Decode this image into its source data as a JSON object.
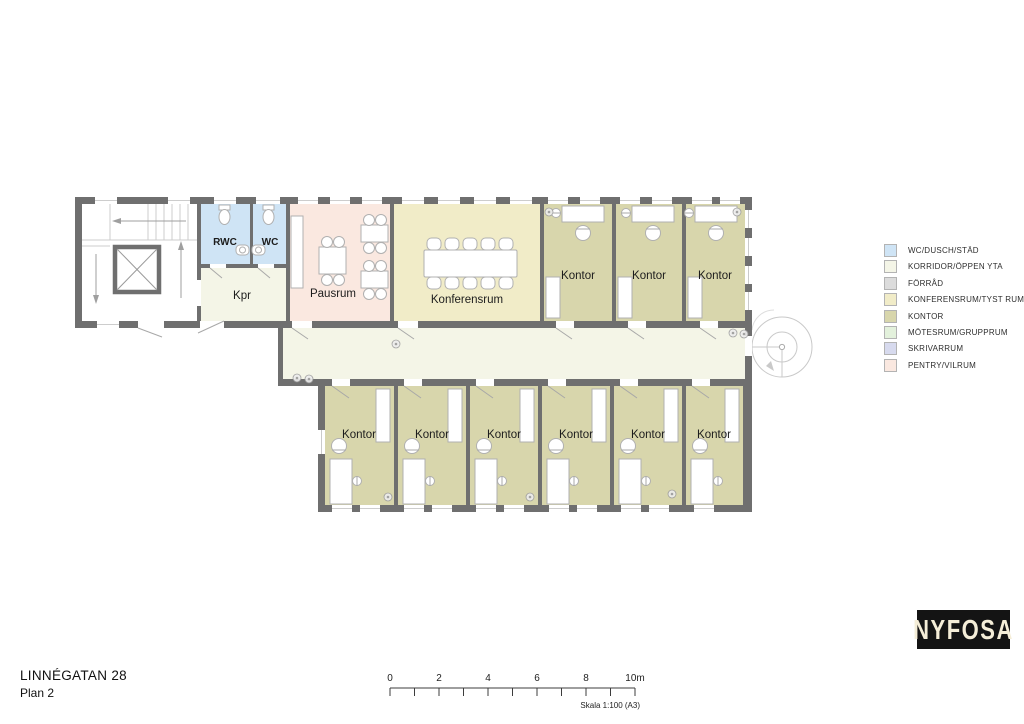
{
  "plan": {
    "wall_color": "#6f6f6f",
    "room_labels": {
      "rwc": "RWC",
      "wc": "WC",
      "kpr": "Kpr",
      "pausrum": "Pausrum",
      "konferensrum": "Konferensrum",
      "kontor": "Kontor"
    }
  },
  "legend": {
    "items": [
      {
        "label": "WC/DUSCH/STÄD",
        "color": "#cfe4f5"
      },
      {
        "label": "KORRIDOR/ÖPPEN YTA",
        "color": "#f4f5e7"
      },
      {
        "label": "FÖRRÅD",
        "color": "#dcdcdc"
      },
      {
        "label": "KONFERENSRUM/TYST RUM",
        "color": "#f1ecc8"
      },
      {
        "label": "KONTOR",
        "color": "#d8d6ac"
      },
      {
        "label": "MÖTESRUM/GRUPPRUM",
        "color": "#e3f1dc"
      },
      {
        "label": "SKRIVARRUM",
        "color": "#d7daee"
      },
      {
        "label": "PENTRY/VILRUM",
        "color": "#fae8e0"
      }
    ]
  },
  "footer": {
    "address": "LINNÉGATAN 28",
    "plan_name": "Plan 2",
    "scale_ticks": [
      "0",
      "2",
      "4",
      "6",
      "8",
      "10m"
    ],
    "scale_caption": "Skala 1:100 (A3)"
  },
  "logo": {
    "text": "NYFOSA"
  }
}
